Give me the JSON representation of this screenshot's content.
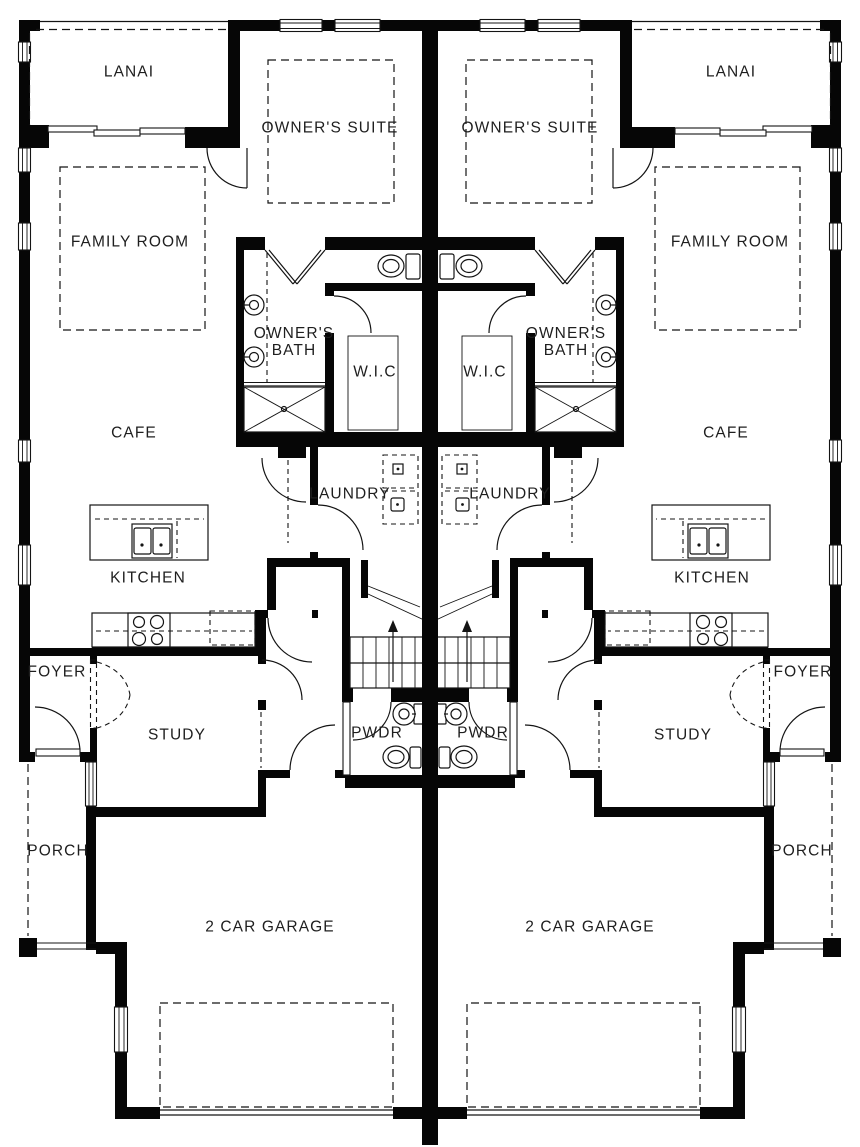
{
  "rooms": {
    "lanai": "LANAI",
    "owners_suite": "OWNER'S SUITE",
    "family_room": "FAMILY ROOM",
    "owners_bath_top": "OWNER'S",
    "owners_bath_bottom": "BATH",
    "wic": "W.I.C",
    "cafe": "CAFE",
    "laundry": "LAUNDRY",
    "kitchen": "KITCHEN",
    "foyer": "FOYER",
    "study": "STUDY",
    "powder": "PWDR",
    "porch": "PORCH",
    "garage": "2 CAR GARAGE"
  },
  "colors": {
    "wall": "#060606",
    "line": "#141414",
    "background": "#ffffff"
  }
}
